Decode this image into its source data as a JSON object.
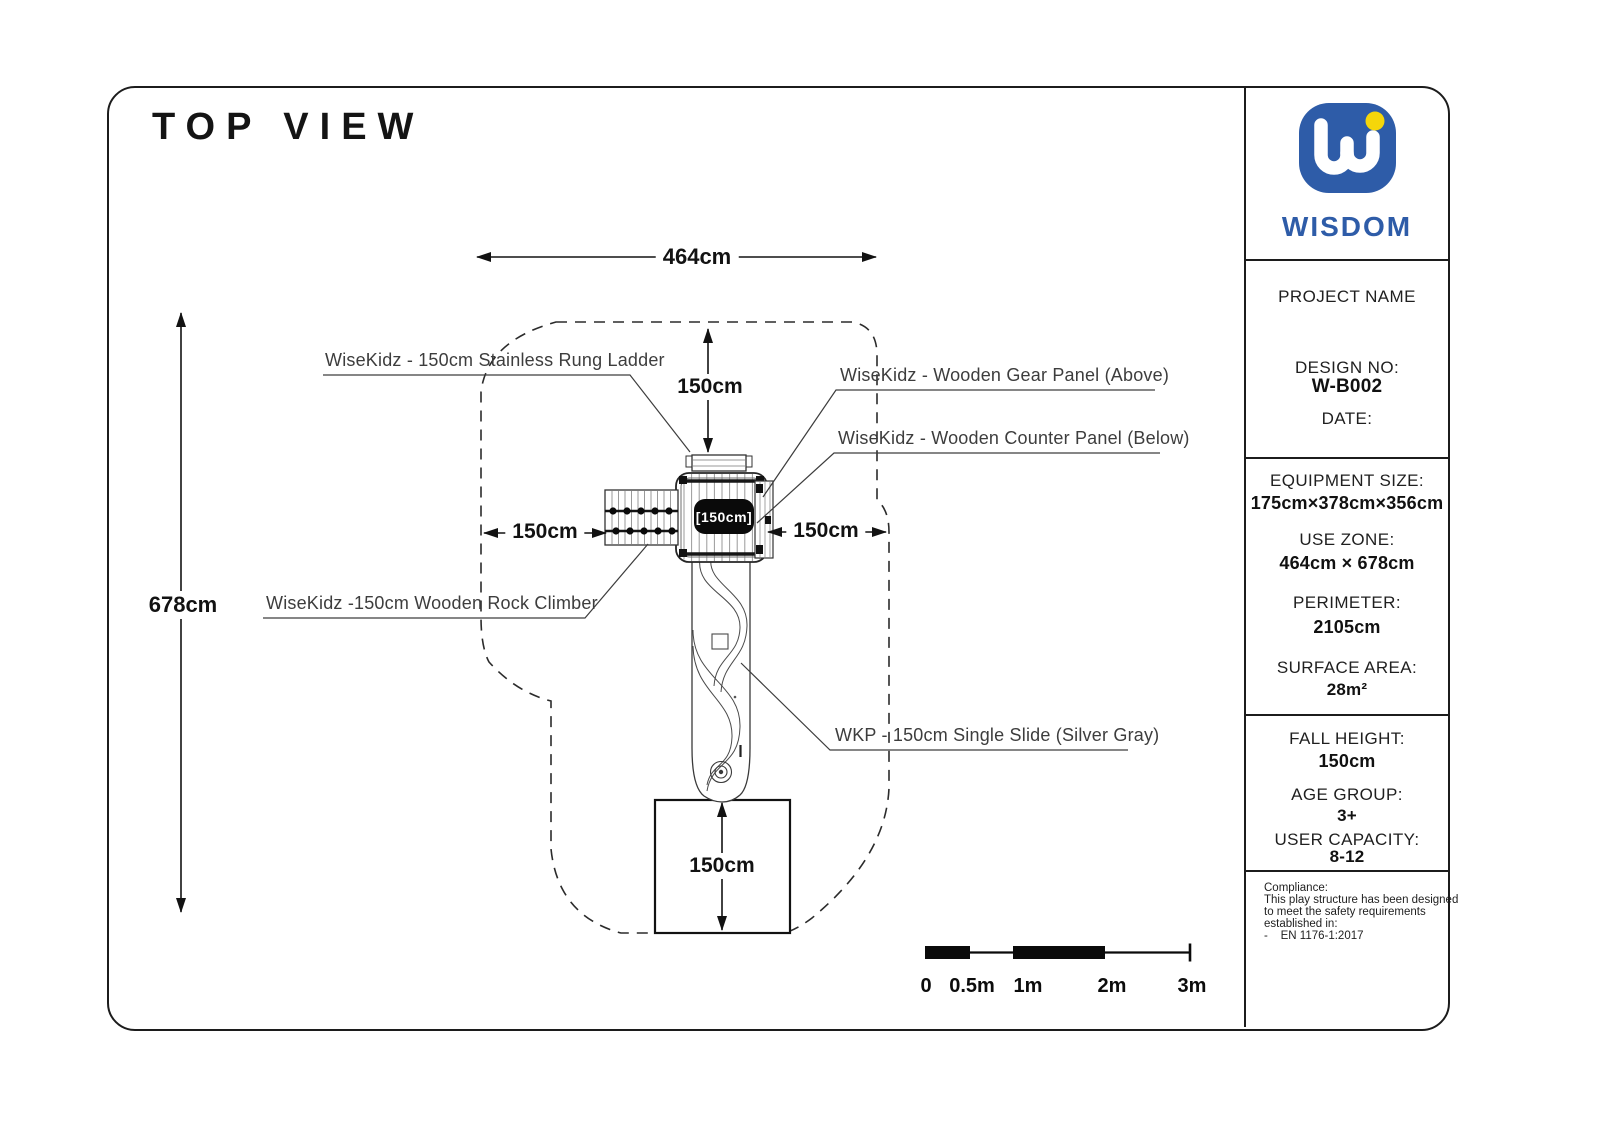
{
  "page": {
    "title": "TOP VIEW"
  },
  "brand": {
    "name": "WISDOM"
  },
  "drawing": {
    "dim_width": "464cm",
    "dim_height": "678cm",
    "dim_top": "150cm",
    "dim_left": "150cm",
    "dim_right": "150cm",
    "dim_exit": "150cm",
    "platform_badge": "[150cm]",
    "labels": {
      "ladder": "WiseKidz - 150cm Stainless Rung Ladder",
      "gear_panel": "WiseKidz - Wooden Gear Panel (Above)",
      "counter_panel": "WiseKidz - Wooden Counter Panel (Below)",
      "rock_climber": "WiseKidz -150cm Wooden Rock Climber",
      "slide": "WKP - 150cm Single Slide (Silver Gray)"
    },
    "scalebar": {
      "zero": "0",
      "half": "0.5m",
      "one": "1m",
      "two": "2m",
      "three": "3m"
    }
  },
  "titleblock": {
    "project_name_label": "PROJECT NAME",
    "design_no_label": "DESIGN NO:",
    "design_no": "W-B002",
    "date_label": "DATE:",
    "equipment_size_label": "EQUIPMENT SIZE:",
    "equipment_size": "175cm×378cm×356cm",
    "use_zone_label": "USE ZONE:",
    "use_zone": "464cm × 678cm",
    "perimeter_label": "PERIMETER:",
    "perimeter": "2105cm",
    "surface_area_label": "SURFACE AREA:",
    "surface_area": "28m²",
    "fall_height_label": "FALL HEIGHT:",
    "fall_height": "150cm",
    "age_group_label": "AGE GROUP:",
    "age_group": "3+",
    "user_capacity_label": "USER CAPACITY:",
    "user_capacity": "8-12",
    "compliance_heading": "Compliance:",
    "compliance_line1": "This play structure has been designed",
    "compliance_line2": "to meet the safety requirements",
    "compliance_line3": "established in:",
    "compliance_line4": "-    EN 1176-1:2017"
  },
  "colors": {
    "brand_blue": "#2e5ca8",
    "accent_yellow": "#f5d60a",
    "ink": "#1a1a1a",
    "label_gray": "#3d3d3d"
  }
}
